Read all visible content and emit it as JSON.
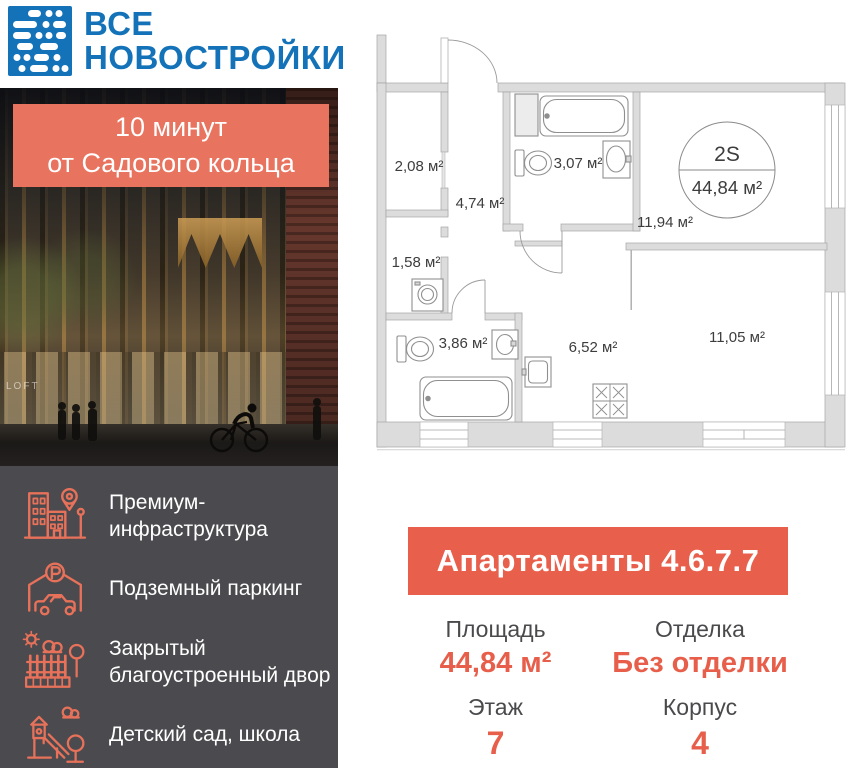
{
  "brand": {
    "line1": "ВСЕ",
    "line2": "НОВОСТРОЙКИ"
  },
  "photo": {
    "badge_line1": "10 минут",
    "badge_line2": "от Садового кольца",
    "signage": "LOFT"
  },
  "features": [
    {
      "icon": "premium-infrastructure-icon",
      "label": "Премиум-инфраструктура"
    },
    {
      "icon": "underground-parking-icon",
      "label": "Подземный паркинг"
    },
    {
      "icon": "closed-yard-icon",
      "label": "Закрытый благоустроенный двор"
    },
    {
      "icon": "kindergarten-school-icon",
      "label": "Детский сад, школа"
    }
  ],
  "plan": {
    "unit_type": "2S",
    "total_area": "44,84 м²",
    "rooms": [
      {
        "name": "closet",
        "area": "2,08 м²"
      },
      {
        "name": "hallway",
        "area": "4,74 м²"
      },
      {
        "name": "bathroom-top",
        "area": "3,07 м²"
      },
      {
        "name": "living-kitchen",
        "area": "11,94 м²"
      },
      {
        "name": "laundry",
        "area": "1,58 м²"
      },
      {
        "name": "bathroom-bottom",
        "area": "3,86 м²"
      },
      {
        "name": "kitchen",
        "area": "6,52 м²"
      },
      {
        "name": "room",
        "area": "11,05 м²"
      }
    ]
  },
  "listing": {
    "title": "Апартаменты 4.6.7.7",
    "stats": [
      {
        "label": "Площадь",
        "value": "44,84 м²"
      },
      {
        "label": "Отделка",
        "value": "Без отделки"
      },
      {
        "label": "Этаж",
        "value": "7"
      },
      {
        "label": "Корпус",
        "value": "4"
      }
    ]
  },
  "colors": {
    "brand_blue": "#1472B8",
    "accent_coral": "#E8735E",
    "accent_strong": "#E75F4B",
    "panel_dark": "#4B4B4F",
    "label_gray": "#4A4A4C"
  }
}
